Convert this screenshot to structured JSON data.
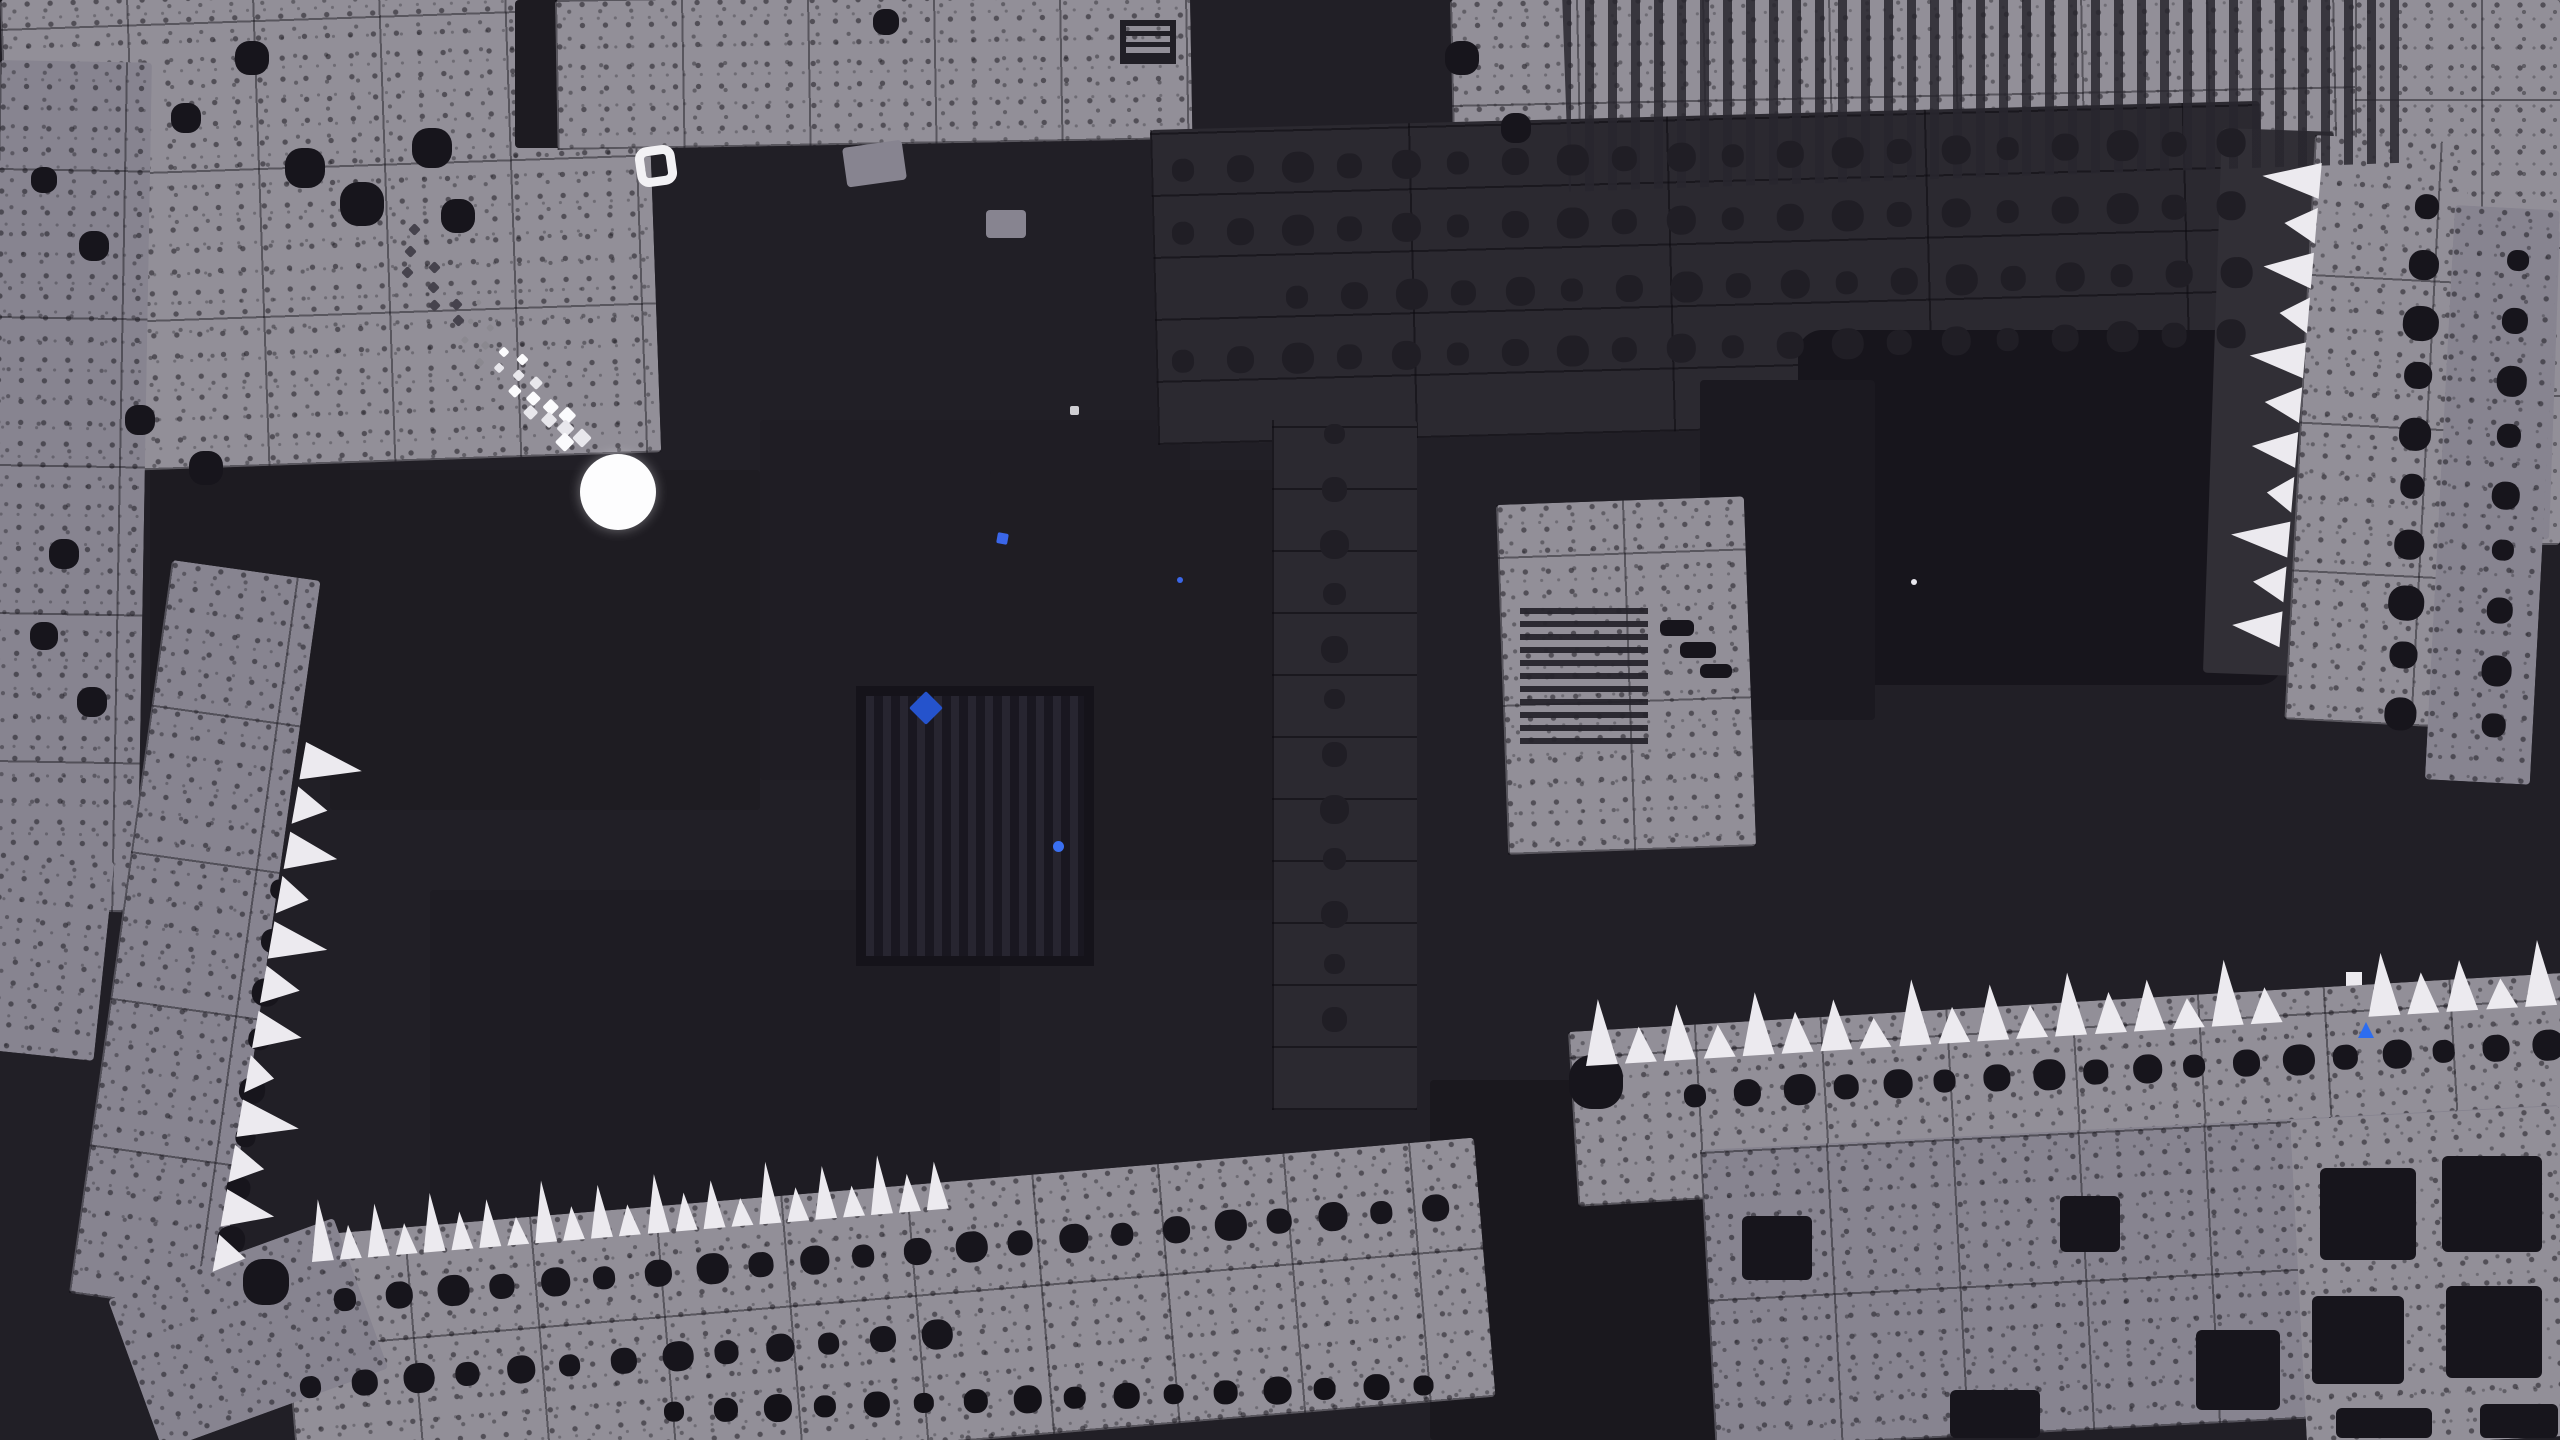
{
  "meta": {
    "scene": "monochrome pixel platformer cavern with player ball and blue portal",
    "viewport": {
      "w": 2560,
      "h": 1440
    }
  },
  "palette": {
    "bg": "#211f26",
    "bgDark": "#1a181e",
    "bgDarker": "#141218",
    "tile": "#928f98",
    "tileDim": "#878490",
    "wallDark": "#2b2930",
    "wallDot": "#201e25",
    "ink": "#17151c",
    "white": "#eceaef",
    "portalBlue": "#2f97e8",
    "portalCyan": "#45c8f2",
    "portalSquare": "#2d7bf2",
    "particleBlue": "#2f5fd8"
  },
  "terrain": {
    "blocks": [
      {
        "name": "room-shade-a",
        "x": 330,
        "y": 470,
        "w": 430,
        "h": 340,
        "rot": 0,
        "fill": "#1e1c22"
      },
      {
        "name": "room-shade-b",
        "x": 760,
        "y": 420,
        "w": 430,
        "h": 360,
        "rot": 0,
        "fill": "#1f1d24"
      },
      {
        "name": "room-shade-c",
        "x": 430,
        "y": 890,
        "w": 570,
        "h": 330,
        "rot": 0,
        "fill": "#1e1c23"
      },
      {
        "name": "room-shade-d",
        "x": 990,
        "y": 470,
        "w": 300,
        "h": 430,
        "rot": 0,
        "fill": "#1f1d23"
      },
      {
        "name": "room-shade-e",
        "x": 150,
        "y": 450,
        "w": 200,
        "h": 330,
        "rot": 0,
        "fill": "#1d1b21"
      },
      {
        "name": "bottom-gap-dark",
        "x": 1430,
        "y": 1080,
        "w": 310,
        "h": 360,
        "rot": 0,
        "fill": "#1a181e"
      },
      {
        "name": "top-left-tiles",
        "x": 0,
        "y": 0,
        "w": 645,
        "h": 475,
        "rot": -2,
        "fill": "tile",
        "tex": "both"
      },
      {
        "name": "top-left-slot",
        "x": 515,
        "y": 0,
        "w": 132,
        "h": 148,
        "rot": 0,
        "fill": "#1d1b21"
      },
      {
        "name": "left-column",
        "x": 0,
        "y": 60,
        "w": 152,
        "h": 850,
        "rot": 1,
        "fill": "tileDim",
        "tex": "both"
      },
      {
        "name": "left-lower-wedge",
        "x": 0,
        "y": 850,
        "w": 115,
        "h": 200,
        "rot": 6,
        "fill": "tileDim",
        "tex": "speckle"
      },
      {
        "name": "left-wall",
        "x": 172,
        "y": 560,
        "w": 150,
        "h": 740,
        "rot": 8,
        "fill": "tileDim",
        "tex": "both"
      },
      {
        "name": "top-strip",
        "x": 555,
        "y": 0,
        "w": 635,
        "h": 150,
        "rot": -1,
        "fill": "tile",
        "tex": "both"
      },
      {
        "name": "top-right-structure",
        "x": 1450,
        "y": 0,
        "w": 1115,
        "h": 255,
        "rot": -1.2,
        "fill": "tile",
        "tex": "both"
      },
      {
        "name": "top-right-column",
        "x": 2355,
        "y": 0,
        "w": 205,
        "h": 545,
        "rot": 0,
        "fill": "tile",
        "tex": "both"
      },
      {
        "name": "top-right-step",
        "x": 2425,
        "y": 225,
        "w": 135,
        "h": 310,
        "rot": 2,
        "fill": "tileDim",
        "tex": "speckle"
      },
      {
        "name": "dot-wall",
        "x": 1150,
        "y": 130,
        "w": 1110,
        "h": 315,
        "rot": -1.5,
        "fill": "wallDark",
        "tex": "darkseams"
      },
      {
        "name": "dot-wall-strip",
        "x": 1272,
        "y": 420,
        "w": 145,
        "h": 690,
        "rot": 0,
        "fill": "wallDark",
        "tex": "darkseams"
      },
      {
        "name": "portal-chamber",
        "x": 1798,
        "y": 330,
        "w": 485,
        "h": 355,
        "rot": 0,
        "fill": "ink",
        "r": 24
      },
      {
        "name": "mid-dark",
        "x": 1700,
        "y": 380,
        "w": 175,
        "h": 340,
        "rot": 0,
        "fill": "#1b1920"
      },
      {
        "name": "right-wall-dark",
        "x": 2222,
        "y": 128,
        "w": 112,
        "h": 545,
        "rot": 2,
        "fill": "#312f36"
      },
      {
        "name": "right-wall-gray",
        "x": 2315,
        "y": 135,
        "w": 155,
        "h": 585,
        "rot": 3,
        "fill": "tile",
        "tex": "both"
      },
      {
        "name": "right-wall-outer",
        "x": 2455,
        "y": 205,
        "w": 105,
        "h": 575,
        "rot": 3,
        "fill": "tileDim",
        "tex": "speckle"
      },
      {
        "name": "mid-right-block",
        "x": 1496,
        "y": 505,
        "w": 248,
        "h": 350,
        "rot": -2,
        "fill": "tile",
        "tex": "both"
      },
      {
        "name": "floor-left",
        "x": 278,
        "y": 1238,
        "w": 1200,
        "h": 260,
        "rot": -4.8,
        "fill": "tile",
        "tex": "both"
      },
      {
        "name": "floor-left-wedge",
        "x": 108,
        "y": 1300,
        "w": 240,
        "h": 160,
        "rot": -20,
        "fill": "tileDim",
        "tex": "speckle"
      },
      {
        "name": "ledge-right",
        "x": 1568,
        "y": 1032,
        "w": 1000,
        "h": 175,
        "rot": -3.4,
        "fill": "tile",
        "tex": "both"
      },
      {
        "name": "corner-bottom-right",
        "x": 1700,
        "y": 1150,
        "w": 860,
        "h": 300,
        "rot": -3,
        "fill": "tileDim",
        "tex": "both"
      },
      {
        "name": "corner-bottom-right-2",
        "x": 2290,
        "y": 1120,
        "w": 270,
        "h": 330,
        "rot": -3,
        "fill": "tile",
        "tex": "speckle"
      },
      {
        "name": "debris-1",
        "x": 842,
        "y": 148,
        "w": 60,
        "h": 40,
        "rot": -8,
        "fill": "tileDim"
      },
      {
        "name": "debris-2",
        "x": 986,
        "y": 210,
        "w": 40,
        "h": 28,
        "rot": 0,
        "fill": "tileDim"
      }
    ],
    "grates": [
      {
        "name": "large-vertical-grate",
        "kind": "vgrate",
        "x": 856,
        "y": 686,
        "w": 238,
        "h": 280
      },
      {
        "name": "horizontal-vent",
        "kind": "hvent",
        "x": 1520,
        "y": 604,
        "w": 128,
        "h": 140
      },
      {
        "name": "top-right-stripes",
        "kind": "trstripes",
        "x": 1562,
        "y": -8,
        "w": 838,
        "h": 200,
        "rot": -2
      },
      {
        "name": "wall-glyph",
        "kind": "glyph",
        "x": 1120,
        "y": 20,
        "w": 56,
        "h": 44
      }
    ],
    "squares": {
      "color": "ink",
      "items": [
        [
          2320,
          1168,
          96,
          92
        ],
        [
          2442,
          1156,
          100,
          96
        ],
        [
          2312,
          1296,
          92,
          88
        ],
        [
          2446,
          1286,
          96,
          92
        ],
        [
          2196,
          1330,
          84,
          80
        ],
        [
          2336,
          1408,
          96,
          30
        ],
        [
          1742,
          1216,
          70,
          64
        ],
        [
          1950,
          1390,
          90,
          48
        ],
        [
          2480,
          1404,
          78,
          34
        ],
        [
          2060,
          1196,
          60,
          56
        ],
        [
          1660,
          620,
          34,
          16
        ],
        [
          1680,
          642,
          36,
          16
        ],
        [
          1700,
          664,
          32,
          14
        ]
      ]
    },
    "blobs": {
      "color": "ink",
      "items": [
        [
          305,
          168,
          40
        ],
        [
          362,
          204,
          44
        ],
        [
          432,
          148,
          40
        ],
        [
          458,
          216,
          34
        ],
        [
          252,
          58,
          34
        ],
        [
          186,
          118,
          30
        ],
        [
          94,
          246,
          30
        ],
        [
          44,
          180,
          26
        ],
        [
          140,
          420,
          30
        ],
        [
          206,
          468,
          34
        ],
        [
          64,
          554,
          30
        ],
        [
          44,
          636,
          28
        ],
        [
          92,
          702,
          30
        ],
        [
          266,
          1282,
          46
        ],
        [
          1462,
          58,
          34
        ],
        [
          1516,
          128,
          30
        ],
        [
          886,
          22,
          26
        ],
        [
          1596,
          1082,
          54
        ]
      ]
    },
    "dot_rows": [
      {
        "name": "wall-dots-row-1",
        "x": 1172,
        "y": 170,
        "count": 20,
        "sp": 55,
        "s": 27,
        "dir": "h",
        "rot": -1.5,
        "c": "wallDot"
      },
      {
        "name": "wall-dots-row-2",
        "x": 1172,
        "y": 233,
        "count": 20,
        "sp": 55,
        "s": 27,
        "dir": "h",
        "rot": -1.5,
        "c": "wallDot"
      },
      {
        "name": "wall-dots-row-3",
        "x": 1286,
        "y": 297,
        "count": 18,
        "sp": 55,
        "s": 27,
        "dir": "h",
        "rot": -1.5,
        "c": "wallDot"
      },
      {
        "name": "wall-dots-row-4",
        "x": 1172,
        "y": 361,
        "count": 20,
        "sp": 55,
        "s": 27,
        "dir": "h",
        "rot": -1.5,
        "c": "wallDot"
      },
      {
        "name": "wall-dots-column",
        "x": 1322,
        "y": 436,
        "count": 12,
        "sp": 53,
        "s": 25,
        "dir": "v",
        "rot": 0,
        "c": "wallDot"
      },
      {
        "name": "right-wall-dots-1",
        "x": 2398,
        "y": 208,
        "count": 10,
        "sp": 56,
        "s": 30,
        "dir": "v",
        "rot": 3,
        "c": "ink"
      },
      {
        "name": "right-wall-dots-2",
        "x": 2492,
        "y": 262,
        "count": 9,
        "sp": 58,
        "s": 26,
        "dir": "v",
        "rot": 3,
        "c": "ink"
      },
      {
        "name": "left-wall-dots",
        "x": 242,
        "y": 888,
        "count": 8,
        "sp": 50,
        "s": 24,
        "dir": "v",
        "rot": 8,
        "c": "ink"
      },
      {
        "name": "floor-dots-row-1",
        "x": 334,
        "y": 1300,
        "count": 22,
        "sp": 52,
        "s": 27,
        "dir": "h",
        "rot": -4.8,
        "c": "ink"
      },
      {
        "name": "floor-dots-row-2",
        "x": 300,
        "y": 1388,
        "count": 13,
        "sp": 52,
        "s": 26,
        "dir": "h",
        "rot": -4.8,
        "c": "ink"
      },
      {
        "name": "bottom-dots-row",
        "x": 664,
        "y": 1412,
        "count": 16,
        "sp": 50,
        "s": 24,
        "dir": "h",
        "rot": -2,
        "c": "bgDarker"
      },
      {
        "name": "ledge-dots-row",
        "x": 1684,
        "y": 1096,
        "count": 18,
        "sp": 50,
        "s": 27,
        "dir": "h",
        "rot": -3.4,
        "c": "ink"
      }
    ],
    "spike_rows": [
      {
        "name": "spikes-bottom-left",
        "x": 312,
        "y": 1262,
        "len": 645,
        "count": 23,
        "dir": "up",
        "rot": -4.8,
        "hmax": 62,
        "gaps": []
      },
      {
        "name": "spikes-bottom-right",
        "x": 1586,
        "y": 1066,
        "len": 980,
        "count": 25,
        "dir": "up",
        "rot": -3.6,
        "hmax": 66,
        "gaps": [
          18,
          19
        ]
      },
      {
        "name": "spikes-left-wall",
        "x": 306,
        "y": 742,
        "len": 545,
        "count": 12,
        "dir": "right",
        "rot": 10,
        "hmax": 60,
        "gaps": []
      },
      {
        "name": "spikes-right-wall",
        "x": 2322,
        "y": 158,
        "len": 495,
        "count": 11,
        "dir": "left",
        "rot": 5,
        "hmax": 58,
        "gaps": []
      }
    ]
  },
  "entities": {
    "player": {
      "x": 618,
      "y": 492,
      "d": 76,
      "color": "#fdfdfe"
    },
    "trail_main": {
      "from": [
        462,
        318
      ],
      "to": [
        578,
        442
      ],
      "count": 20,
      "minS": 5,
      "maxS": 14
    },
    "trail_dark": {
      "from": [
        398,
        244
      ],
      "to": [
        462,
        318
      ],
      "count": 8,
      "s": 9,
      "c": "#46434d"
    },
    "ring_marker": {
      "x": 636,
      "y": 146,
      "w": 40,
      "h": 40,
      "rot": -8
    },
    "portal": {
      "cx": 2022,
      "cy": 474
    },
    "tree_marker": {
      "x": 2316,
      "y": 972
    },
    "down_arrow": {
      "x": 2338,
      "y": 582
    },
    "particles": [
      {
        "name": "blue-diamond",
        "x": 926,
        "y": 708,
        "s": 24,
        "c": "#2553cc",
        "rot": 45,
        "shape": "square"
      },
      {
        "name": "blue-dot",
        "x": 1058,
        "y": 846,
        "s": 11,
        "c": "#3a6ff0",
        "rot": 0,
        "shape": "dot"
      },
      {
        "name": "blue-square",
        "x": 1002,
        "y": 538,
        "s": 11,
        "c": "#3a66e8",
        "rot": 10,
        "shape": "square"
      },
      {
        "name": "gray-speck",
        "x": 1074,
        "y": 410,
        "s": 9,
        "c": "#cfced3",
        "rot": 0,
        "shape": "square"
      },
      {
        "name": "white-speck",
        "x": 1914,
        "y": 582,
        "s": 6,
        "c": "#e8e7ee",
        "rot": 0,
        "shape": "dot"
      },
      {
        "name": "tiny-blue-dot",
        "x": 1180,
        "y": 580,
        "s": 6,
        "c": "#3a66e8",
        "rot": 0,
        "shape": "dot"
      },
      {
        "name": "blue-tri",
        "x": 2366,
        "y": 1030,
        "s": 16,
        "c": "#2d6df0",
        "rot": 0,
        "shape": "tri"
      }
    ]
  }
}
